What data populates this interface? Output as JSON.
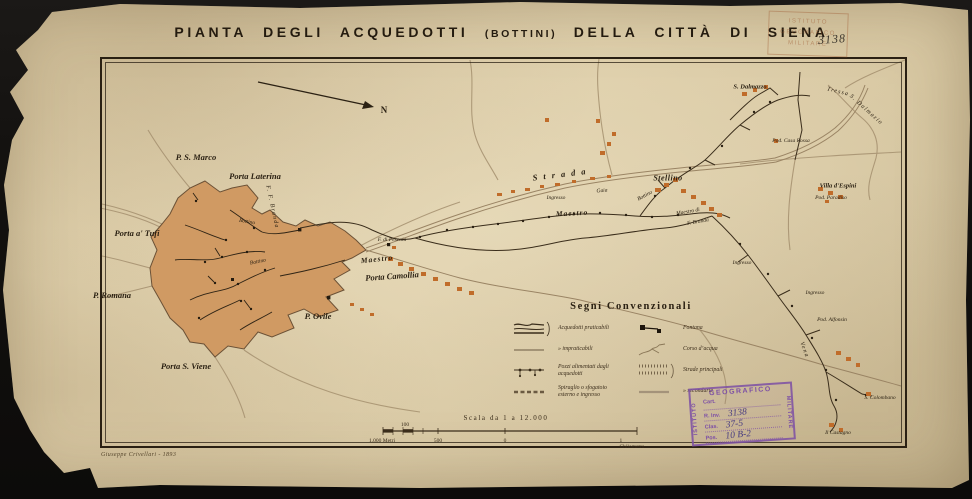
{
  "title": {
    "part1": "PIANTA  DEGLI  ACQUEDOTTI",
    "part2": "(BOTTINI)",
    "part3": "DELLA  CITTÀ  DI  SIENA"
  },
  "colors": {
    "paper": "#d9c9a4",
    "ink": "#2b2113",
    "city_fill": "#d09a63",
    "building_orange": "#c06c2a",
    "road_gray": "#a5906f",
    "stamp_purple": "#7d4fa5"
  },
  "legend": {
    "title": "Segni  Convenzionali",
    "left": [
      {
        "icon": "aqueduct-practicable",
        "label": "Acquedotti  praticabili"
      },
      {
        "icon": "aqueduct-impracticable",
        "label": "»   impraticabili"
      },
      {
        "icon": "wells",
        "label": "Pozzi alimentati dagli acquedotti"
      },
      {
        "icon": "vent",
        "label": "Spiraglio o sfogatoio esterno e ingresso"
      }
    ],
    "right": [
      {
        "icon": "fountain",
        "label": "Fontana"
      },
      {
        "icon": "watercourse",
        "label": "Corso d’acqua"
      },
      {
        "icon": "main-roads",
        "label": "Strade principali"
      },
      {
        "icon": "secondary-roads",
        "label": "»   secondarie"
      }
    ]
  },
  "scale": {
    "caption": "Scala  da  1  a  12.000",
    "tick_top": "100",
    "labels": [
      "1.000 Metri",
      "500",
      "0",
      "1 Chilometro"
    ]
  },
  "stamps": {
    "purple": {
      "arc_top": "GEOGRAFICO",
      "side_left": "ISTITUTO",
      "side_right": "MILITARE",
      "line1_label": "Cart.",
      "line2_label": "R. Inv.",
      "line2_value": "3138",
      "line3_label": "Clas.",
      "line3_value": "37-5",
      "line4_label": "Pos.",
      "line4_value": "10 B-2"
    },
    "faded": {
      "line1": "ISTITUTO",
      "line2": "GEOGRAFICO",
      "line3": "MILITARE",
      "handwritten": "3138"
    }
  },
  "credit": "Giuseppe Crivellari - 1893",
  "map": {
    "labels": [
      {
        "text": "N",
        "x": 384,
        "y": 110,
        "cls": "north"
      },
      {
        "text": "P. S. Marco",
        "x": 196,
        "y": 157,
        "cls": "gate"
      },
      {
        "text": "Porta Laterina",
        "x": 255,
        "y": 176,
        "cls": "gate"
      },
      {
        "text": "Porta a' Tufi",
        "x": 137,
        "y": 233,
        "cls": "gate"
      },
      {
        "text": "P. Romana",
        "x": 112,
        "y": 295,
        "cls": "gate"
      },
      {
        "text": "Porta S. Viene",
        "x": 186,
        "y": 366,
        "cls": "gate"
      },
      {
        "text": "P. Ovile",
        "x": 318,
        "y": 316,
        "cls": "gate"
      },
      {
        "text": "Porta Camollia",
        "x": 392,
        "y": 276,
        "cls": "gate",
        "rot": -4
      },
      {
        "text": "F. di Pescaia",
        "x": 392,
        "y": 240,
        "cls": "tiny"
      },
      {
        "text": "Maestro",
        "x": 377,
        "y": 259,
        "cls": "line",
        "rot": -6
      },
      {
        "text": "Bottino",
        "x": 258,
        "y": 262,
        "cls": "tiny",
        "rot": -12
      },
      {
        "text": "Bottino",
        "x": 247,
        "y": 222,
        "cls": "tiny",
        "rot": 10
      },
      {
        "text": "F. F. Branda",
        "x": 272,
        "y": 207,
        "cls": "water",
        "rot": 78
      },
      {
        "text": "Maestro",
        "x": 572,
        "y": 213,
        "cls": "line",
        "rot": -3
      },
      {
        "text": "Gaia",
        "x": 602,
        "y": 191,
        "cls": "tiny",
        "rot": -5
      },
      {
        "text": "Bottino",
        "x": 645,
        "y": 196,
        "cls": "tiny",
        "rot": -28
      },
      {
        "text": "Strada",
        "x": 562,
        "y": 174,
        "cls": "road",
        "rot": -7
      },
      {
        "text": "Stellino",
        "x": 668,
        "y": 178,
        "cls": "place"
      },
      {
        "text": "Maestro di",
        "x": 688,
        "y": 212,
        "cls": "tiny",
        "rot": -10
      },
      {
        "text": "F. Branda",
        "x": 698,
        "y": 222,
        "cls": "tiny",
        "rot": -10
      },
      {
        "text": "Ingresso",
        "x": 556,
        "y": 198,
        "cls": "tiny"
      },
      {
        "text": "Ingresso",
        "x": 742,
        "y": 263,
        "cls": "tiny"
      },
      {
        "text": "Ingresso",
        "x": 815,
        "y": 293,
        "cls": "tiny"
      },
      {
        "text": "S. Dalmazzo",
        "x": 750,
        "y": 87,
        "cls": "place-sm"
      },
      {
        "text": "Tressa",
        "x": 838,
        "y": 92,
        "cls": "water",
        "rot": 14
      },
      {
        "text": "S. Dalmazio",
        "x": 866,
        "y": 110,
        "cls": "water",
        "rot": 42
      },
      {
        "text": "Pod. Casa Rossa",
        "x": 791,
        "y": 141,
        "cls": "tiny"
      },
      {
        "text": "Villa d'Espini",
        "x": 838,
        "y": 186,
        "cls": "place-sm"
      },
      {
        "text": "Pod. Paradiso",
        "x": 831,
        "y": 198,
        "cls": "tiny"
      },
      {
        "text": "Pod. Alfonsin",
        "x": 832,
        "y": 320,
        "cls": "tiny"
      },
      {
        "text": "Vena",
        "x": 804,
        "y": 350,
        "cls": "water",
        "rot": 70
      },
      {
        "text": "S. Colombano",
        "x": 880,
        "y": 398,
        "cls": "tiny"
      },
      {
        "text": "Il Castagno",
        "x": 838,
        "y": 433,
        "cls": "tiny"
      }
    ]
  }
}
